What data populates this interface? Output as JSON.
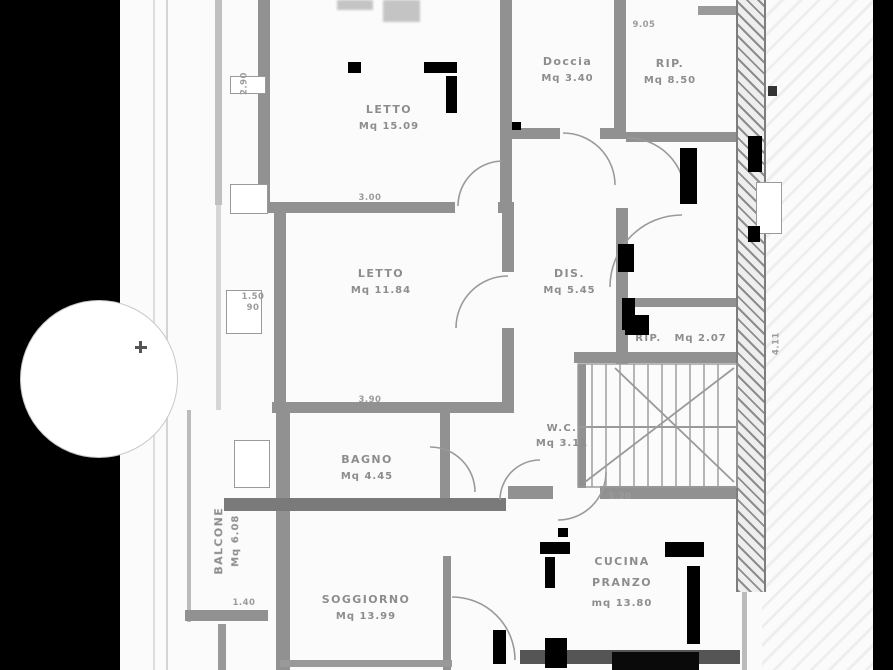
{
  "document": {
    "type": "scanned floor plan",
    "language": "Italian",
    "colors": {
      "paper": "#fbfbfb",
      "wall": "#919191",
      "label_text": "#8d8d8d",
      "scan_border": "#000000"
    }
  },
  "rooms": [
    {
      "name": "LETTO",
      "area": "Mq 15.09"
    },
    {
      "name": "Doccia",
      "area": "Mq 3.40"
    },
    {
      "name": "RIP.",
      "area": "Mq 8.50"
    },
    {
      "name": "LETTO",
      "area": "Mq 11.84"
    },
    {
      "name": "DIS.",
      "area": "Mq 5.45"
    },
    {
      "name": "RIP.",
      "area": "Mq 2.07"
    },
    {
      "name": "BAGNO",
      "area": "Mq 4.45"
    },
    {
      "name": "W.C.",
      "area": "Mq 3.11"
    },
    {
      "name": "SOGGIORNO",
      "area": "Mq 13.99"
    },
    {
      "name": "CUCINA",
      "name2": "PRANZO",
      "area": "mq 13.80"
    },
    {
      "name": "BALCONE",
      "area": "Mq 6.08"
    }
  ],
  "dimensions": [
    {
      "text": "2.90"
    },
    {
      "text": "3.00"
    },
    {
      "text": "1.50"
    },
    {
      "text": "90"
    },
    {
      "text": "3.90"
    },
    {
      "text": "1.20"
    },
    {
      "text": "1.40"
    },
    {
      "text": "4.11"
    },
    {
      "text": "9.05"
    }
  ]
}
